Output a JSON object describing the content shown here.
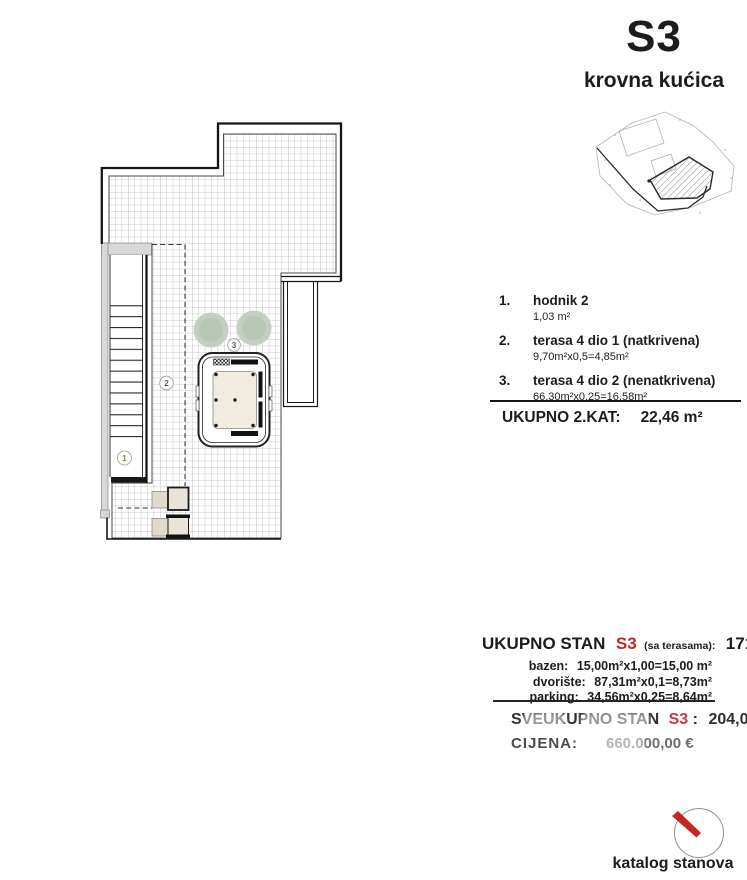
{
  "header": {
    "unit_code": "S3",
    "unit_type": "krovna kućica"
  },
  "legend": {
    "items": [
      {
        "num": "1.",
        "name": "hodnik 2",
        "formula": "1,03 m²"
      },
      {
        "num": "2.",
        "name": "terasa 4 dio 1 (natkrivena)",
        "formula": "9,70m²x0,5=4,85m²"
      },
      {
        "num": "3.",
        "name": "terasa 4 dio 2 (nenatkrivena)",
        "formula": "66,30m²x0,25=16,58m²"
      }
    ],
    "floor_total_label": "UKUPNO 2.KAT:",
    "floor_total_value": "22,46 m²"
  },
  "totals": {
    "flat_label": "UKUPNO STAN",
    "flat_code": "S3",
    "flat_note": "(sa terasama):",
    "flat_value": "171,67 m²",
    "extras": [
      {
        "name": "bazen:",
        "formula": "15,00m²x1,00=15,00 m²"
      },
      {
        "name": "dvorište:",
        "formula": "87,31m²x0,1=8,73m²"
      },
      {
        "name": "parking:",
        "formula": "34,56m²x0,25=8,64m²"
      }
    ],
    "grand_label": "SVEUKUPNO STAN",
    "grand_code": "S3",
    "grand_sep": ":",
    "grand_value": "204,04 m²",
    "price_label": "CIJENA:",
    "price_value": "660.000,00 €"
  },
  "plan": {
    "label1": "1",
    "label2": "2",
    "label3": "3"
  },
  "footer": {
    "catalog_label": "katalog stanova"
  },
  "colors": {
    "accent_red": "#c42626",
    "text": "#1c1c1c"
  }
}
